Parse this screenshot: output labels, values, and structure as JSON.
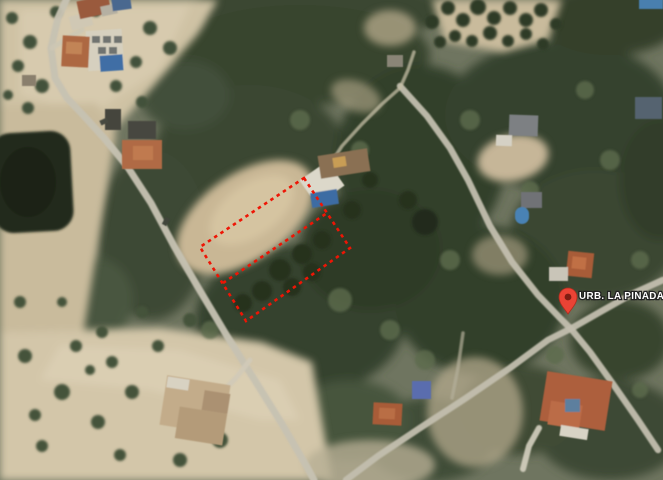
{
  "map": {
    "type": "satellite-aerial-view",
    "label": {
      "text": "URB. LA PINADA",
      "x": 579,
      "y": 299,
      "size": 9.8,
      "fill": "#ffffff",
      "halo": "#222222"
    },
    "pin": {
      "x": 568,
      "y": 314,
      "fill": "#EA4335",
      "outline": "#b02c1d",
      "dot": "#7e1d12"
    },
    "plot_outline": {
      "points": "304,178 350,248 246,321 200,247",
      "midline": "223,283 327,213",
      "color": "#ee1505",
      "dash": "3.5 4",
      "width": 2.6
    },
    "colors": {
      "base": "#6f7560",
      "forest_dark": "#333f2b",
      "sand": "#cfc2a4",
      "road": "#c6c2b2",
      "pond": "#232c1a",
      "roof_terracotta": "#ad6742",
      "pool_blue": "#3f6ea5",
      "annotation_red": "#ee1505"
    }
  },
  "scene": {
    "forest": [
      [
        320,
        10,
        125,
        32,
        "#3a4630",
        1
      ],
      [
        300,
        55,
        130,
        50,
        "#39452f",
        1
      ],
      [
        250,
        150,
        95,
        65,
        "#3a4632",
        1
      ],
      [
        185,
        95,
        45,
        35,
        "#42503a",
        1
      ],
      [
        152,
        235,
        55,
        85,
        "#3c4834",
        1
      ],
      [
        300,
        320,
        105,
        75,
        "#36422e",
        1
      ],
      [
        420,
        160,
        85,
        95,
        "#333f2b",
        1
      ],
      [
        560,
        115,
        115,
        75,
        "#36422d",
        1
      ],
      [
        610,
        20,
        70,
        35,
        "#35412c",
        1
      ],
      [
        595,
        235,
        85,
        65,
        "#3a4631",
        1
      ],
      [
        480,
        300,
        85,
        75,
        "#333f2b",
        1
      ],
      [
        610,
        430,
        75,
        50,
        "#3d4934",
        1
      ],
      [
        430,
        440,
        65,
        42,
        "#414e38",
        1
      ],
      [
        350,
        420,
        60,
        40,
        "#47543c",
        1
      ],
      [
        95,
        300,
        38,
        42,
        "#4a573f",
        1
      ],
      [
        620,
        340,
        50,
        40,
        "#38442f",
        1
      ],
      [
        520,
        410,
        60,
        45,
        "#3f4b36",
        1
      ],
      [
        660,
        180,
        40,
        60,
        "#313d29",
        1
      ],
      [
        370,
        250,
        70,
        60,
        "#2f3b28",
        1
      ]
    ],
    "tan": [
      {
        "t": "p",
        "d": "M0,0 L218,0 L198,34 L152,88 L116,128 L62,148 L0,124 Z",
        "f": "#cfc2a4",
        "o": 1
      },
      {
        "t": "p",
        "d": "M20,10 L190,5 L160,70 L90,115 L20,95 Z",
        "f": "#d8ccb0",
        "o": 0.8
      },
      {
        "t": "p",
        "d": "M432,0 L562,0 L548,40 L503,52 L445,42 Z",
        "f": "#c9bb9c",
        "o": 1
      },
      {
        "t": "e",
        "cx": 245,
        "cy": 217,
        "rx": 78,
        "ry": 43,
        "rot": -35,
        "f": "#c9b795",
        "o": 1
      },
      {
        "t": "e",
        "cx": 252,
        "cy": 210,
        "rx": 48,
        "ry": 26,
        "rot": -35,
        "f": "#d7c7a3",
        "o": 0.85
      },
      {
        "t": "e",
        "cx": 513,
        "cy": 158,
        "rx": 36,
        "ry": 23,
        "rot": -12,
        "f": "#c6b698",
        "o": 1
      },
      {
        "t": "p",
        "d": "M0,332 L160,328 L262,342 L312,362 L332,480 L0,480 Z",
        "f": "#d3c6a9",
        "o": 1
      },
      {
        "t": "p",
        "d": "M60,345 L180,350 L280,380 L300,420 L260,420 L150,390 L40,380 Z",
        "f": "#ddd2b6",
        "o": 0.7
      },
      {
        "t": "p",
        "d": "M0,106 L96,103 L116,133 L98,243 L84,330 L0,332 Z",
        "f": "#c9bb9c",
        "o": 1
      },
      {
        "t": "e",
        "cx": 475,
        "cy": 412,
        "rx": 48,
        "ry": 55,
        "rot": 0,
        "f": "#b3a88c",
        "o": 0.75
      },
      {
        "t": "e",
        "cx": 390,
        "cy": 28,
        "rx": 26,
        "ry": 18,
        "rot": 0,
        "f": "#c2b394",
        "o": 0.7
      },
      {
        "t": "e",
        "cx": 356,
        "cy": 96,
        "rx": 26,
        "ry": 15,
        "rot": 20,
        "f": "#b9ad90",
        "o": 0.6
      },
      {
        "t": "e",
        "cx": 370,
        "cy": 465,
        "rx": 65,
        "ry": 25,
        "rot": 0,
        "f": "#b7ae93",
        "o": 0.8
      },
      {
        "t": "e",
        "cx": 500,
        "cy": 255,
        "rx": 28,
        "ry": 20,
        "rot": 0,
        "f": "#b5a98c",
        "o": 0.6
      }
    ],
    "trees": [
      [
        448,
        8,
        7,
        "#2f3b28",
        1
      ],
      [
        463,
        20,
        7,
        "#2f3b28",
        1
      ],
      [
        478,
        7,
        8,
        "#2f3b28",
        1
      ],
      [
        494,
        18,
        7,
        "#2f3b28",
        1
      ],
      [
        510,
        8,
        7,
        "#2f3b28",
        1
      ],
      [
        526,
        20,
        7,
        "#2f3b28",
        1
      ],
      [
        541,
        10,
        7,
        "#2f3b28",
        1
      ],
      [
        556,
        24,
        6,
        "#2f3b28",
        1
      ],
      [
        455,
        36,
        6,
        "#2f3b28",
        1
      ],
      [
        472,
        41,
        6,
        "#2f3b28",
        1
      ],
      [
        490,
        33,
        7,
        "#2f3b28",
        1
      ],
      [
        508,
        41,
        6,
        "#2f3b28",
        1
      ],
      [
        526,
        34,
        6,
        "#2f3b28",
        1
      ],
      [
        543,
        44,
        6,
        "#2f3b28",
        1
      ],
      [
        432,
        22,
        7,
        "#2f3b28",
        1
      ],
      [
        440,
        42,
        6,
        "#2f3b28",
        1
      ],
      [
        12,
        18,
        6,
        "#43513a",
        1
      ],
      [
        30,
        42,
        7,
        "#43513a",
        1
      ],
      [
        18,
        66,
        6,
        "#43513a",
        1
      ],
      [
        42,
        86,
        7,
        "#43513a",
        1
      ],
      [
        28,
        108,
        6,
        "#43513a",
        1
      ],
      [
        56,
        12,
        6,
        "#43513a",
        1
      ],
      [
        96,
        12,
        5,
        "#43513a",
        1
      ],
      [
        150,
        28,
        7,
        "#43513a",
        1
      ],
      [
        170,
        48,
        7,
        "#43513a",
        1
      ],
      [
        136,
        62,
        6,
        "#43513a",
        1
      ],
      [
        116,
        86,
        6,
        "#43513a",
        1
      ],
      [
        142,
        102,
        6,
        "#43513a",
        1
      ],
      [
        80,
        60,
        5,
        "#43513a",
        1
      ],
      [
        8,
        95,
        5,
        "#43513a",
        1
      ],
      [
        25,
        356,
        7,
        "#45523b",
        1
      ],
      [
        62,
        392,
        8,
        "#45523b",
        1
      ],
      [
        98,
        422,
        7,
        "#45523b",
        1
      ],
      [
        42,
        446,
        6,
        "#45523b",
        1
      ],
      [
        132,
        392,
        7,
        "#45523b",
        1
      ],
      [
        76,
        346,
        6,
        "#45523b",
        1
      ],
      [
        112,
        362,
        6,
        "#45523b",
        1
      ],
      [
        158,
        346,
        6,
        "#45523b",
        1
      ],
      [
        20,
        302,
        6,
        "#45523b",
        1
      ],
      [
        62,
        302,
        5,
        "#45523b",
        1
      ],
      [
        102,
        332,
        6,
        "#45523b",
        1
      ],
      [
        142,
        312,
        6,
        "#45523b",
        1
      ],
      [
        190,
        320,
        7,
        "#45523b",
        1
      ],
      [
        220,
        440,
        8,
        "#45523b",
        1
      ],
      [
        180,
        460,
        7,
        "#45523b",
        1
      ],
      [
        120,
        455,
        6,
        "#45523b",
        1
      ],
      [
        90,
        370,
        5,
        "#45523b",
        1
      ],
      [
        35,
        415,
        6,
        "#45523b",
        1
      ],
      [
        280,
        270,
        11,
        "#27311f",
        1
      ],
      [
        302,
        254,
        10,
        "#27311f",
        1
      ],
      [
        262,
        291,
        10,
        "#27311f",
        1
      ],
      [
        322,
        240,
        9,
        "#27311f",
        1
      ],
      [
        243,
        303,
        9,
        "#27311f",
        1
      ],
      [
        312,
        272,
        9,
        "#27311f",
        1
      ],
      [
        292,
        287,
        9,
        "#27311f",
        1
      ],
      [
        425,
        222,
        13,
        "#222c1d",
        1
      ],
      [
        408,
        200,
        9,
        "#27311f",
        1
      ],
      [
        370,
        180,
        8,
        "#27311f",
        1
      ],
      [
        352,
        210,
        9,
        "#27311f",
        1
      ],
      [
        340,
        300,
        12,
        "#5c6a4c",
        0.8
      ],
      [
        390,
        330,
        10,
        "#5c6a4c",
        0.8
      ],
      [
        450,
        260,
        10,
        "#5c6a4c",
        0.8
      ],
      [
        530,
        190,
        9,
        "#5c6a4c",
        0.8
      ],
      [
        610,
        160,
        10,
        "#5c6a4c",
        0.8
      ],
      [
        640,
        260,
        9,
        "#5c6a4c",
        0.8
      ],
      [
        360,
        150,
        9,
        "#5c6a4c",
        0.8
      ],
      [
        470,
        120,
        10,
        "#5c6a4c",
        0.8
      ],
      [
        585,
        90,
        9,
        "#5c6a4c",
        0.8
      ],
      [
        425,
        360,
        10,
        "#5c6a4c",
        0.8
      ],
      [
        555,
        355,
        9,
        "#5c6a4c",
        0.8
      ],
      [
        640,
        390,
        8,
        "#5c6a4c",
        0.8
      ],
      [
        300,
        120,
        10,
        "#5c6a4c",
        0.8
      ],
      [
        210,
        330,
        9,
        "#5c6a4c",
        0.8
      ]
    ],
    "pond": {
      "x": -8,
      "y": 132,
      "w": 80,
      "h": 100,
      "rx": 20,
      "rot": -3,
      "fill": "#232c1a",
      "inner": [
        28,
        182,
        28,
        35,
        "#1b2414"
      ]
    },
    "roads": [
      {
        "pts": "68,-4 58,18 51,48 55,78 67,98 84,116 104,138 127,166 151,203 174,246 199,289 227,336 254,379 282,424 307,467 314,480",
        "w": 7,
        "c": "#c6c2b2",
        "o": 0.95
      },
      {
        "pts": "400,86 427,116 450,148 468,180 490,226 512,262 538,295 560,318 572,330 590,352 613,384 638,420 658,450",
        "w": 6.5,
        "c": "#c2beae",
        "o": 0.95
      },
      {
        "pts": "346,480 378,456 420,428 466,398 510,368 548,340 572,328 600,312 632,294 663,280",
        "w": 6.5,
        "c": "#c2beae",
        "o": 0.95
      },
      {
        "pts": "320,180 342,146 362,124 382,104 400,88 408,70 414,52",
        "w": 3.5,
        "c": "#c4bda6",
        "o": 0.75
      },
      {
        "pts": "250,360 236,378 222,392",
        "w": 5,
        "c": "#d0cab8",
        "o": 0.9
      },
      {
        "pts": "463,333 458,368 452,398",
        "w": 3.5,
        "c": "#b4ae98",
        "o": 0.7
      },
      {
        "pts": "52,48 68,38 82,30",
        "w": 5,
        "c": "#ccc6b4",
        "o": 0.9
      },
      {
        "pts": "523,469 529,446 539,428",
        "w": 6,
        "c": "#d5d0c0",
        "o": 0.9
      }
    ],
    "buildings": [
      [
        70,
        14,
        22,
        14,
        -15,
        "#cfc8b5",
        0.85,
        0
      ],
      [
        78,
        -2,
        32,
        18,
        -12,
        "#9a5a3e",
        1,
        0
      ],
      [
        101,
        5,
        16,
        10,
        -12,
        "#b5b0a2",
        1,
        0
      ],
      [
        112,
        -2,
        19,
        12,
        -8,
        "#49678f",
        1,
        0
      ],
      [
        87,
        30,
        36,
        40,
        -4,
        "#d6d0bf",
        1,
        0
      ],
      [
        92,
        36,
        8,
        7,
        0,
        "#70736f",
        1,
        0
      ],
      [
        103,
        36,
        8,
        7,
        0,
        "#70736f",
        1,
        0
      ],
      [
        114,
        36,
        8,
        7,
        0,
        "#70736f",
        1,
        0
      ],
      [
        98,
        47,
        8,
        7,
        0,
        "#70736f",
        1,
        0
      ],
      [
        109,
        47,
        8,
        7,
        0,
        "#70736f",
        1,
        0
      ],
      [
        100,
        55,
        23,
        16,
        -4,
        "#3f6ea5",
        1,
        0
      ],
      [
        62,
        36,
        27,
        31,
        3,
        "#ad6742",
        1,
        0
      ],
      [
        66,
        42,
        16,
        12,
        3,
        "#c28457",
        1,
        0
      ],
      [
        22,
        75,
        14,
        11,
        0,
        "#8a7f6d",
        1,
        0
      ],
      [
        122,
        140,
        40,
        29,
        0,
        "#b06a44",
        1,
        0
      ],
      [
        128,
        121,
        28,
        18,
        0,
        "#474740",
        1,
        0
      ],
      [
        133,
        146,
        20,
        14,
        0,
        "#c07a50",
        1,
        0
      ],
      [
        305,
        168,
        34,
        30,
        -35,
        "#dcd8ca",
        1,
        0
      ],
      [
        319,
        152,
        50,
        23,
        -9,
        "#8a7052",
        1,
        0
      ],
      [
        333,
        157,
        13,
        10,
        -9,
        "#c89d55",
        1,
        0
      ],
      [
        311,
        191,
        27,
        15,
        -9,
        "#3e6ca3",
        1,
        0
      ],
      [
        509,
        115,
        29,
        21,
        2,
        "#7d8083",
        1,
        0
      ],
      [
        496,
        135,
        16,
        11,
        2,
        "#d5d1c5",
        1,
        0
      ],
      [
        521,
        192,
        21,
        16,
        0,
        "#6f7276",
        1,
        0
      ],
      [
        515,
        207,
        14,
        17,
        0,
        "#4a82b4",
        1,
        7
      ],
      [
        567,
        252,
        26,
        25,
        6,
        "#a85c38",
        1,
        0
      ],
      [
        572,
        257,
        14,
        12,
        6,
        "#c06f45",
        1,
        0
      ],
      [
        549,
        267,
        19,
        14,
        0,
        "#c9c5b8",
        1,
        0
      ],
      [
        635,
        97,
        27,
        22,
        0,
        "#55636f",
        1,
        0
      ],
      [
        639,
        -2,
        24,
        11,
        0,
        "#4a7fae",
        1,
        0
      ],
      [
        163,
        380,
        64,
        50,
        9,
        "#c3ac8a",
        1,
        0
      ],
      [
        177,
        410,
        48,
        32,
        9,
        "#b49b79",
        1,
        0
      ],
      [
        167,
        378,
        22,
        11,
        9,
        "#d8d2c2",
        1,
        0
      ],
      [
        203,
        392,
        26,
        20,
        9,
        "#ab9172",
        1,
        0
      ],
      [
        373,
        403,
        29,
        22,
        3,
        "#a85c38",
        1,
        0
      ],
      [
        379,
        408,
        16,
        11,
        3,
        "#b96e44",
        1,
        0
      ],
      [
        412,
        381,
        19,
        18,
        0,
        "#5a6dae",
        1,
        0
      ],
      [
        543,
        376,
        66,
        50,
        9,
        "#ad5f3e",
        1,
        0
      ],
      [
        549,
        403,
        32,
        24,
        9,
        "#bb6c46",
        1,
        0
      ],
      [
        560,
        427,
        28,
        11,
        9,
        "#d8d3c5",
        1,
        0
      ],
      [
        565,
        399,
        15,
        13,
        0,
        "#5d7f9e",
        1,
        0
      ],
      [
        387,
        55,
        16,
        12,
        0,
        "#8a8577",
        1,
        0
      ],
      [
        105,
        109,
        16,
        21,
        0,
        "#45453d",
        1,
        0
      ],
      [
        100,
        119,
        8,
        5,
        -25,
        "#474a40",
        1,
        0
      ],
      [
        162,
        219,
        8,
        5,
        -60,
        "#41443b",
        1,
        0
      ]
    ]
  }
}
